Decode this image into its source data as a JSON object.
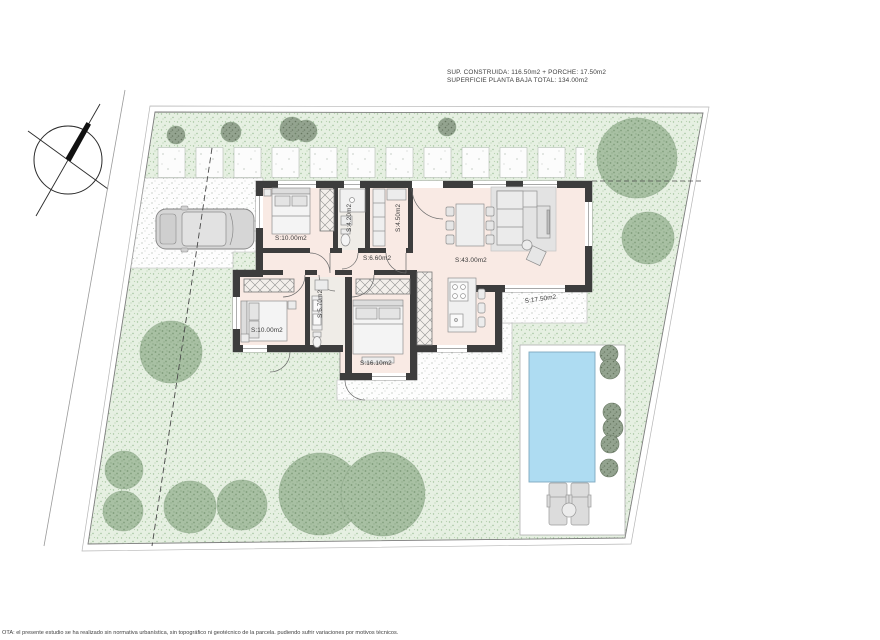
{
  "annotations": {
    "area_line1": "SUP. CONSTRUIDA: 116.50m2 + PORCHE: 17.50m2",
    "area_line2": "SUPERFICIE PLANTA BAJA TOTAL: 134.00m2",
    "disclaimer": "OTA: el presente estudio se ha realizado sin normativa urbanística, sin topográfico ni geotécnico de la parcela. pudiendo sufrir variaciones por motivos técnicos."
  },
  "rooms": [
    {
      "id": "bedroom-1",
      "label": "S:10.00m2"
    },
    {
      "id": "bathroom-1",
      "label": "S:4.20m2"
    },
    {
      "id": "storage-room",
      "label": "S:4.50m2"
    },
    {
      "id": "hallway",
      "label": "S:6.60m2"
    },
    {
      "id": "living-kitchen",
      "label": "S:43.00m2"
    },
    {
      "id": "bathroom-2",
      "label": "S:5.70m2"
    },
    {
      "id": "bedroom-2",
      "label": "S:10.00m2"
    },
    {
      "id": "master-bedroom",
      "label": "S:16.10m2"
    },
    {
      "id": "porch",
      "label": "S:17.50m2"
    }
  ],
  "colors": {
    "lawn": "#e6f0e2",
    "lawn_dot": "#9dbf98",
    "floor": "#f9eae4",
    "wall": "#3d3d3d",
    "pool": "#aedcf2",
    "deck": "#ffffff",
    "tree": "#a8c0a3",
    "tree_dark": "#7d9a78",
    "furniture": "#ececec"
  }
}
